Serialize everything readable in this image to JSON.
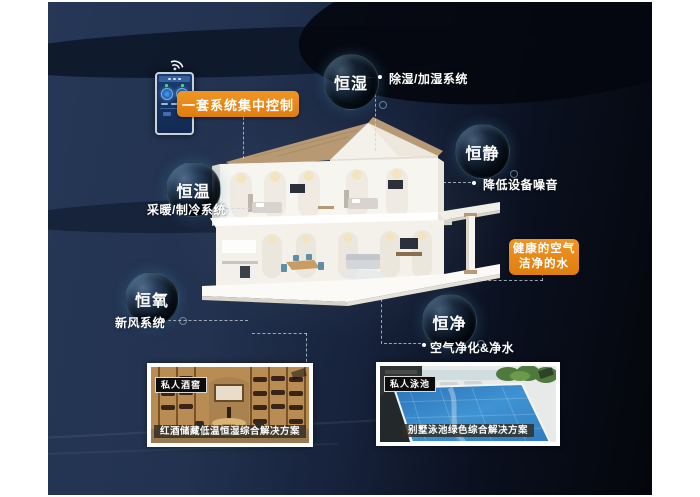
{
  "colors": {
    "accent_orange": "#e8871b",
    "background_navy": "#233357",
    "background_black": "#05070d",
    "connector_line": "#cdd2da"
  },
  "control": {
    "label": "一套系统集中控制"
  },
  "features": [
    {
      "bubble": "恒湿",
      "label": "除湿/加湿系统"
    },
    {
      "bubble": "恒静",
      "label": "降低设备噪音"
    },
    {
      "bubble": "恒温",
      "label": "采暖/制冷系统"
    },
    {
      "bubble": "恒氧",
      "label": "新风系统"
    },
    {
      "bubble": "恒净",
      "label": "空气净化&净水"
    }
  ],
  "highlight_box": {
    "line1": "健康的空气",
    "line2": "洁净的水"
  },
  "cards": [
    {
      "tag": "私人酒窖",
      "caption": "红酒储藏低温恒湿综合解决方案"
    },
    {
      "tag": "私人泳池",
      "caption": "别墅泳池绿色综合解决方案"
    }
  ]
}
